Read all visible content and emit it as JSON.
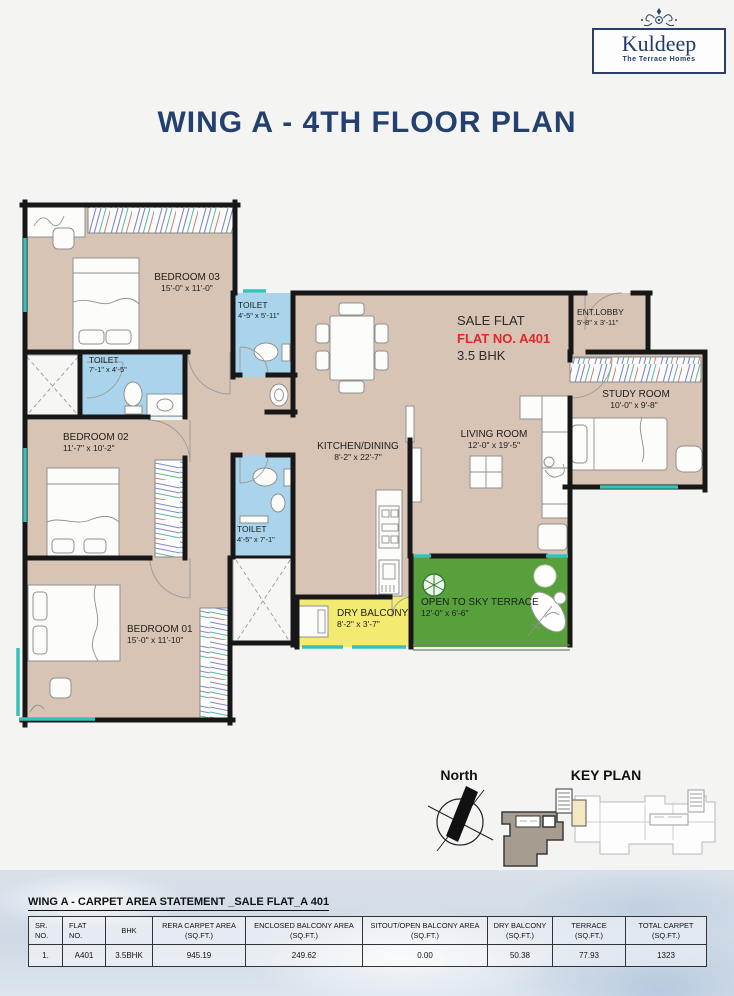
{
  "brand": {
    "name": "Kuldeep",
    "tagline": "The Terrace Homes"
  },
  "page_title": "WING A - 4TH FLOOR PLAN",
  "plan": {
    "sale_flat": {
      "line1": "SALE FLAT",
      "line2": "FLAT NO. A401",
      "line3": "3.5 BHK"
    },
    "rooms": {
      "bedroom03": {
        "name": "BEDROOM 03",
        "dims": "15'-0\" x 11'-0\""
      },
      "toilet_top": {
        "name": "TOILET",
        "dims": "4'-5\" x 5'-11\""
      },
      "toilet_left": {
        "name": "TOILET",
        "dims": "7'-1\" x 4'-5\""
      },
      "bedroom02": {
        "name": "BEDROOM 02",
        "dims": "11'-7\" x 10'-2\""
      },
      "toilet_mid": {
        "name": "TOILET",
        "dims": "4'-5\" x 7'-1\""
      },
      "bedroom01": {
        "name": "BEDROOM 01",
        "dims": "15'-0\" x 11'-10\""
      },
      "kitchen": {
        "name": "KITCHEN/DINING",
        "dims": "8'-2\" x 22'-7\""
      },
      "living": {
        "name": "LIVING ROOM",
        "dims": "12'-0\" x 19'-5\""
      },
      "ent_lobby": {
        "name": "ENT.LOBBY",
        "dims": "5'-8\" x 3'-11\""
      },
      "study": {
        "name": "STUDY ROOM",
        "dims": "10'-0\" x 9'-8\""
      },
      "dry_balcony": {
        "name": "DRY BALCONY",
        "dims": "8'-2\" x 3'-7\""
      },
      "terrace": {
        "name": "OPEN TO SKY TERRACE",
        "dims": "12'-0\" x 6'-6\""
      }
    },
    "north_label": "North",
    "key_plan_label": "KEY PLAN"
  },
  "colors": {
    "navy": "#24406e",
    "red": "#e2262b",
    "floor_beige": "#d7c4b5",
    "toilet_blue": "#a9d4eb",
    "balcony_yellow": "#f3ea71",
    "terrace_green": "#57a03c",
    "window_teal": "#35c2ba",
    "wall": "#171717",
    "key_flat_gray": "#a79c90"
  },
  "table": {
    "title": "WING A - CARPET AREA STATEMENT _SALE FLAT_A 401",
    "headers": [
      {
        "l1": "SR.",
        "l2": "NO."
      },
      {
        "l1": "FLAT",
        "l2": "NO."
      },
      {
        "l1": "BHK",
        "l2": ""
      },
      {
        "l1": "RERA CARPET AREA",
        "l2": "(SQ.FT.)"
      },
      {
        "l1": "ENCLOSED BALCONY AREA",
        "l2": "(SQ.FT.)"
      },
      {
        "l1": "SITOUT/OPEN BALCONY AREA",
        "l2": "(SQ.FT.)"
      },
      {
        "l1": "DRY BALCONY",
        "l2": "(SQ.FT.)"
      },
      {
        "l1": "TERRACE",
        "l2": "(SQ.FT.)"
      },
      {
        "l1": "TOTAL CARPET",
        "l2": "(SQ.FT.)"
      }
    ],
    "rows": [
      [
        "1.",
        "A401",
        "3.5BHK",
        "945.19",
        "249.62",
        "0.00",
        "50.38",
        "77.93",
        "1323"
      ]
    ]
  }
}
